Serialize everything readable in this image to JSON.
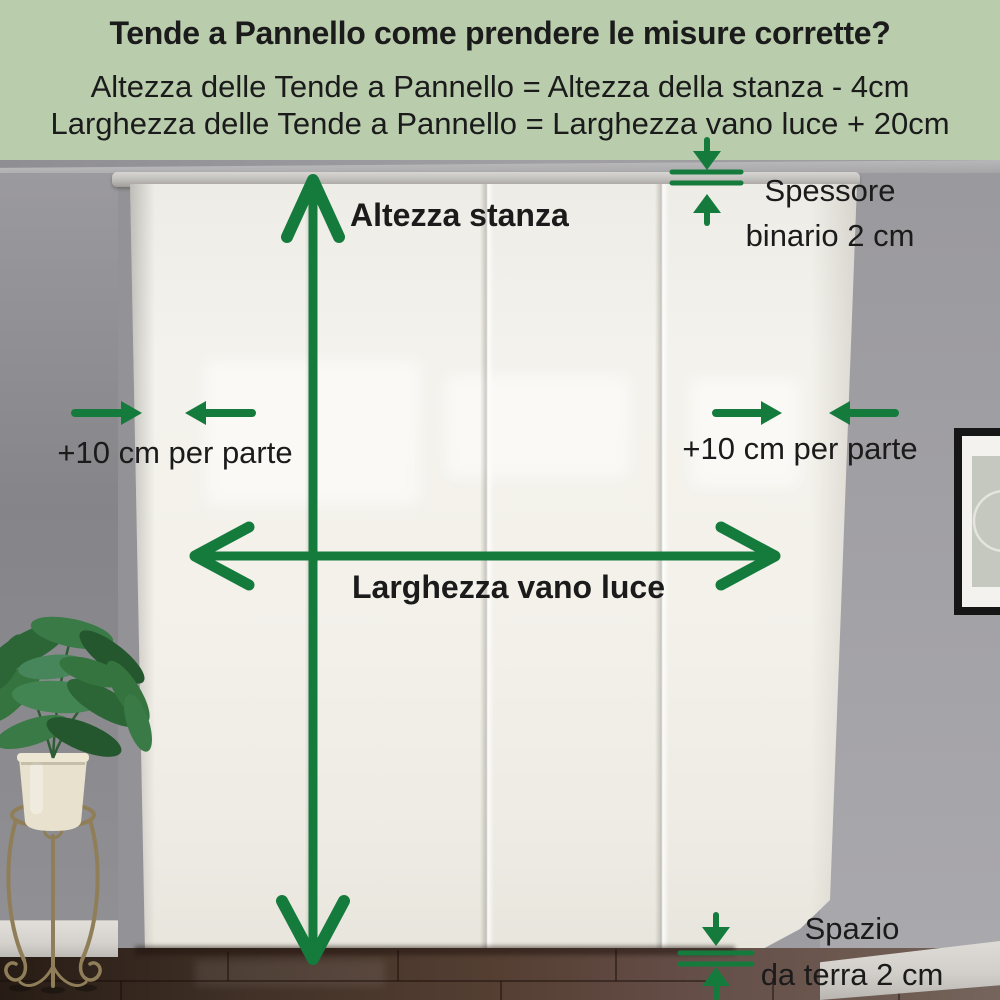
{
  "header": {
    "title": "Tende a Pannello come prendere le misure corrette?",
    "formula_height": "Altezza delle Tende a Pannello = Altezza della stanza - 4cm",
    "formula_width": "Larghezza delle Tende a Pannello = Larghezza vano luce + 20cm"
  },
  "annotations": {
    "room_height_label": "Altezza stanza",
    "opening_width_label": "Larghezza vano luce",
    "side_allowance_left": "+10 cm per parte",
    "side_allowance_right": "+10 cm per parte",
    "rail_thickness_line1": "Spessore",
    "rail_thickness_line2": "binario 2 cm",
    "floor_gap_line1": "Spazio",
    "floor_gap_line2": "da terra 2 cm"
  },
  "palette": {
    "header_bg": "#b9cdad",
    "arrow_green": "#157b3d",
    "text_dark": "#1b1b1b",
    "wall_gray": "#97969a",
    "curtain_white": "#f2f0e9",
    "floor_brown": "#5a473b",
    "baseboard_white": "#d9d6d1",
    "frame_black": "#161616",
    "plant_green": "#35743f",
    "pot_cream": "#e7e1cd",
    "stand_brass": "#8f7e58"
  }
}
